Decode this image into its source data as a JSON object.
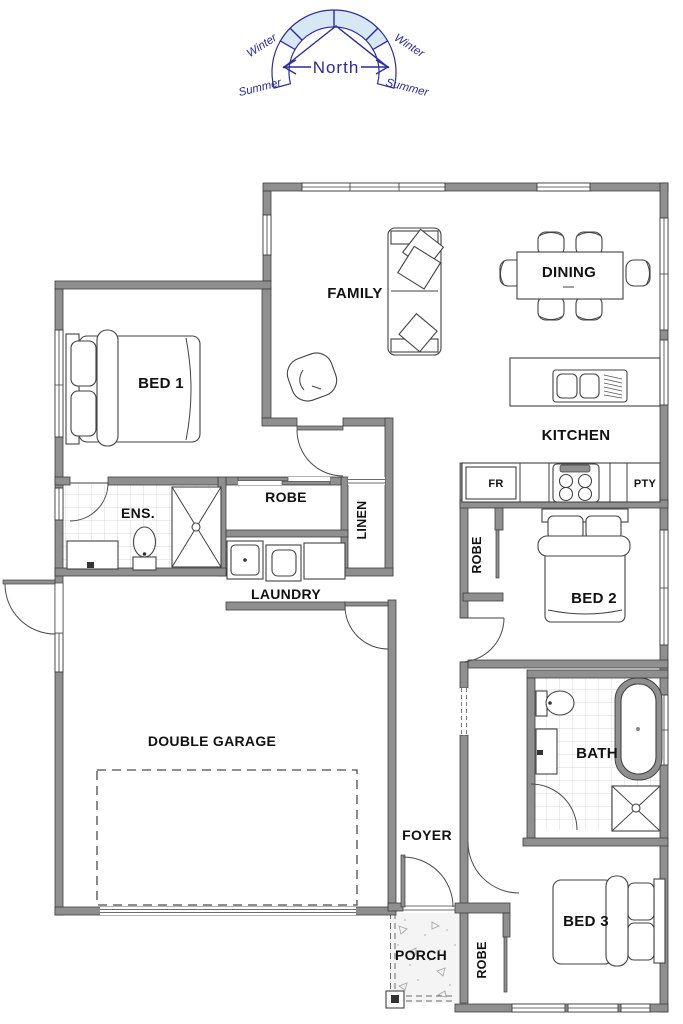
{
  "title": "House floor plan",
  "compass": {
    "north_label": "North",
    "winter_left": "Winter",
    "winter_right": "Winter",
    "summer_left": "Summer",
    "summer_right": "Summer",
    "line_color": "#2a2aa0",
    "band_fill": "#d7e7f3"
  },
  "rooms": {
    "family": "FAMILY",
    "dining": "DINING",
    "kitchen": "KITCHEN",
    "bed1": "BED 1",
    "ens": "ENS.",
    "robe_bed1": "ROBE",
    "linen": "LINEN",
    "laundry": "LAUNDRY",
    "bed2": "BED 2",
    "robe_bed2": "ROBE",
    "garage": "DOUBLE GARAGE",
    "bath": "BATH",
    "foyer": "FOYER",
    "porch": "PORCH",
    "bed3": "BED 3",
    "robe_bed3": "ROBE",
    "fridge": "FR",
    "pantry": "PTY"
  },
  "colors": {
    "wall": "#8f8f8f",
    "wall_edge": "#3e3e3e",
    "furniture_line": "#424242",
    "tile_line": "#cccccc",
    "label_text": "#111111"
  }
}
